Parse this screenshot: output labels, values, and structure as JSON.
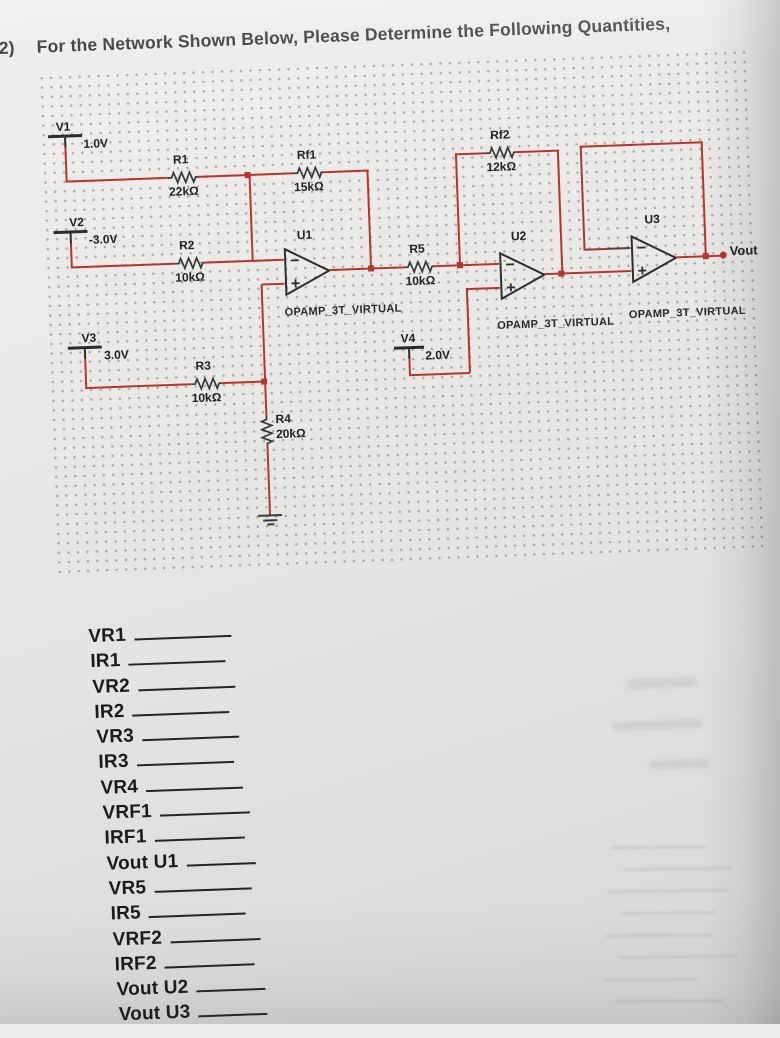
{
  "title": {
    "number": "2)",
    "text": "For the Network Shown Below, Please Determine the Following Quantities,"
  },
  "circuit": {
    "wire_color": "#b5362c",
    "sources": [
      {
        "name": "V1",
        "value": "1.0V"
      },
      {
        "name": "V2",
        "value": "-3.0V"
      },
      {
        "name": "V3",
        "value": "3.0V"
      },
      {
        "name": "V4",
        "value": "2.0V"
      }
    ],
    "resistors": [
      {
        "name": "R1",
        "value": "22kΩ"
      },
      {
        "name": "R2",
        "value": "10kΩ"
      },
      {
        "name": "R3",
        "value": "10kΩ"
      },
      {
        "name": "R4",
        "value": "20kΩ"
      },
      {
        "name": "R5",
        "value": "10kΩ"
      },
      {
        "name": "Rf1",
        "value": "15kΩ"
      },
      {
        "name": "Rf2",
        "value": "12kΩ"
      }
    ],
    "opamps": [
      {
        "name": "U1",
        "model": "OPAMP_3T_VIRTUAL"
      },
      {
        "name": "U2",
        "model": "OPAMP_3T_VIRTUAL"
      },
      {
        "name": "U3",
        "model": "OPAMP_3T_VIRTUAL"
      }
    ],
    "output_label": "Vout"
  },
  "blanks": [
    "VR1",
    "IR1",
    "VR2",
    "IR2",
    "VR3",
    "IR3",
    "VR4",
    "VRF1",
    "IRF1",
    "Vout U1",
    "VR5",
    "IR5",
    "VRF2",
    "IRF2",
    "Vout U2",
    "Vout U3"
  ]
}
